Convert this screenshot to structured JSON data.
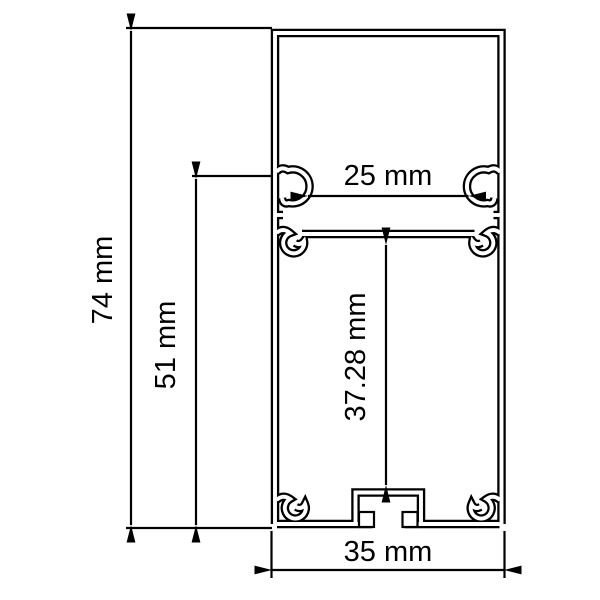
{
  "drawing": {
    "type": "technical-cross-section",
    "subject": "aluminum profile extrusion",
    "background_color": "#ffffff",
    "line_color": "#000000",
    "unit": "mm",
    "dimensions": {
      "overall_height": {
        "label": "74 mm",
        "value": 74,
        "unit": "mm",
        "orientation": "vertical",
        "side": "left-outer"
      },
      "lower_section_height": {
        "label": "51 mm",
        "value": 51,
        "unit": "mm",
        "orientation": "vertical",
        "side": "left-inner"
      },
      "inner_top_width": {
        "label": "25 mm",
        "value": 25,
        "unit": "mm",
        "orientation": "horizontal",
        "side": "inside-top"
      },
      "inner_cavity_height": {
        "label": "37.28 mm",
        "value": 37.28,
        "unit": "mm",
        "orientation": "vertical",
        "side": "inside-center"
      },
      "overall_width": {
        "label": "35 mm",
        "value": 35,
        "unit": "mm",
        "orientation": "horizontal",
        "side": "bottom"
      }
    },
    "features": {
      "cover_clip_hooks": 2,
      "shelf_snap_clips": 2,
      "screw_ports": 2,
      "central_mounting_channel": 1
    }
  }
}
